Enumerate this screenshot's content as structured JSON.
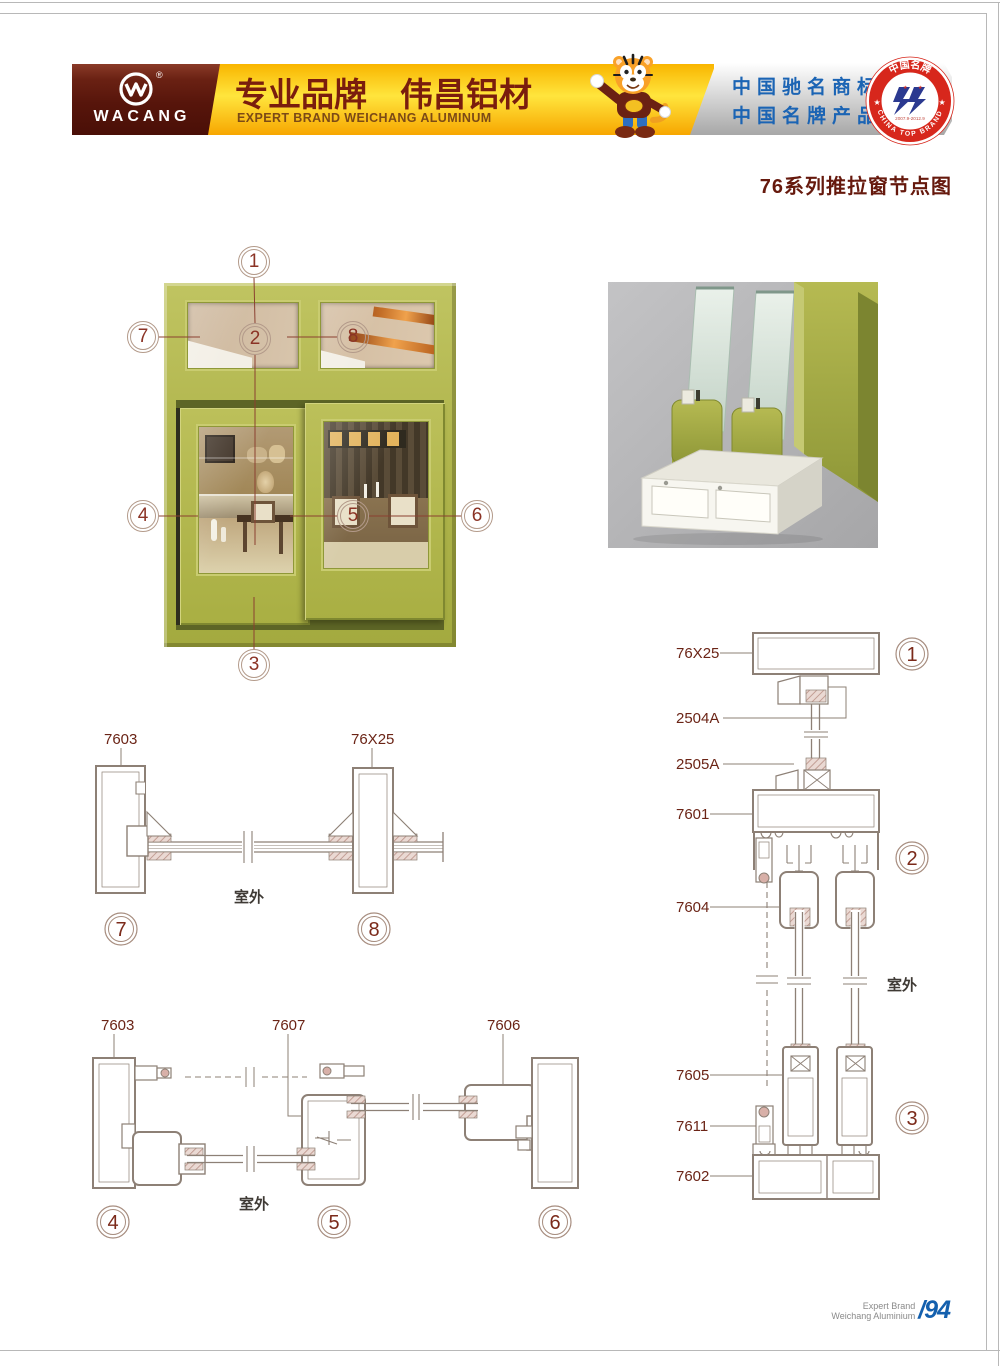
{
  "page_title": "76系列推拉窗节点图",
  "header": {
    "logo": {
      "text": "WACANG",
      "reg": "®"
    },
    "banner": {
      "cn": "专业品牌　伟昌铝材",
      "en": "EXPERT BRAND WEICHANG ALUMINUM"
    },
    "marks": {
      "line1": "中国驰名商标",
      "line2": "中国名牌产品"
    },
    "seal": {
      "arc_top": "中国名牌",
      "arc_bottom": "CHINA TOP BRAND",
      "dates": "2007.9-2012.9"
    }
  },
  "window": {
    "callouts": {
      "c1": "1",
      "c2": "2",
      "c3": "3",
      "c4": "4",
      "c5": "5",
      "c6": "6",
      "c7": "7",
      "c8": "8"
    }
  },
  "drawA": {
    "label_left": "7603",
    "label_right": "76X25",
    "outdoor": "室外",
    "callout_left": "7",
    "callout_right": "8"
  },
  "drawB": {
    "label_left": "7603",
    "label_mid": "7607",
    "label_right": "7606",
    "outdoor": "室外",
    "callout_left": "4",
    "callout_mid": "5",
    "callout_right": "6"
  },
  "drawC": {
    "labels": {
      "l76x25": "76X25",
      "l2504a": "2504A",
      "l2505a": "2505A",
      "l7601": "7601",
      "l7604": "7604",
      "l7605": "7605",
      "l7611": "7611",
      "l7602": "7602"
    },
    "outdoor": "室外",
    "callouts": {
      "c1": "1",
      "c2": "2",
      "c3": "3"
    }
  },
  "footer": {
    "line1": "Expert Brand",
    "line2": "Weichang Aluminium",
    "page": "/94"
  },
  "colors": {
    "olive": "#b2b74f",
    "maroon": "#5d170c",
    "drawing_line": "#8d8076",
    "label": "#6b2416",
    "blue": "#1b64b4",
    "seal_red": "#d7271c"
  }
}
